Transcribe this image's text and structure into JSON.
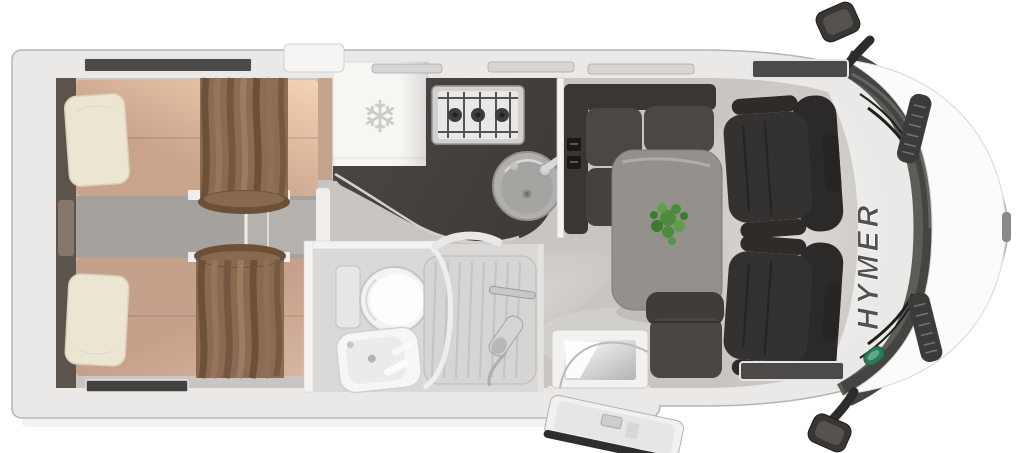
{
  "floorplan": {
    "subject": "motorhome top-view floor plan render",
    "cab": {
      "brand_label": "HYMER"
    },
    "kitchen": {
      "fridge_icon_glyph": "❄"
    }
  },
  "icons": {
    "snowflake-icon": "❄"
  },
  "colors": {
    "body_shell": "#eae9e7",
    "body_edge": "#b5b4b2",
    "floor": "#c9c6c1",
    "aisle": "#a5a29d",
    "headboard": "#5a544d",
    "bed": "#c9a48d",
    "bed_bottom": "#c5a08a",
    "pillow": "#ece5d1",
    "curtain": "#85654d",
    "fridge": "#f7f6f3",
    "snowflake": "#cbcac5",
    "counter": "#47433f",
    "hob_frame": "#d2d1cf",
    "sink": "#b2b0ad",
    "bathroom_floor": "#dad9d7",
    "fixture_white": "#f4f3f1",
    "shower_tray": "#d6d5d3",
    "bench": "#3a3733",
    "cushion": "#4b4743",
    "table": "#94918c",
    "plant": "#4c8c3a",
    "side_seat": "#403d39",
    "cab_chair": "#343230",
    "windshield": "#454442",
    "hood": "#fbfbfa",
    "vent": "#3c3b39",
    "badge_green": "#2a7a58",
    "window_slit": "#4b4a48",
    "silver_rail": "#d7d6d4",
    "door_seal": "#2f2e2d",
    "brand_text": "#525150"
  }
}
